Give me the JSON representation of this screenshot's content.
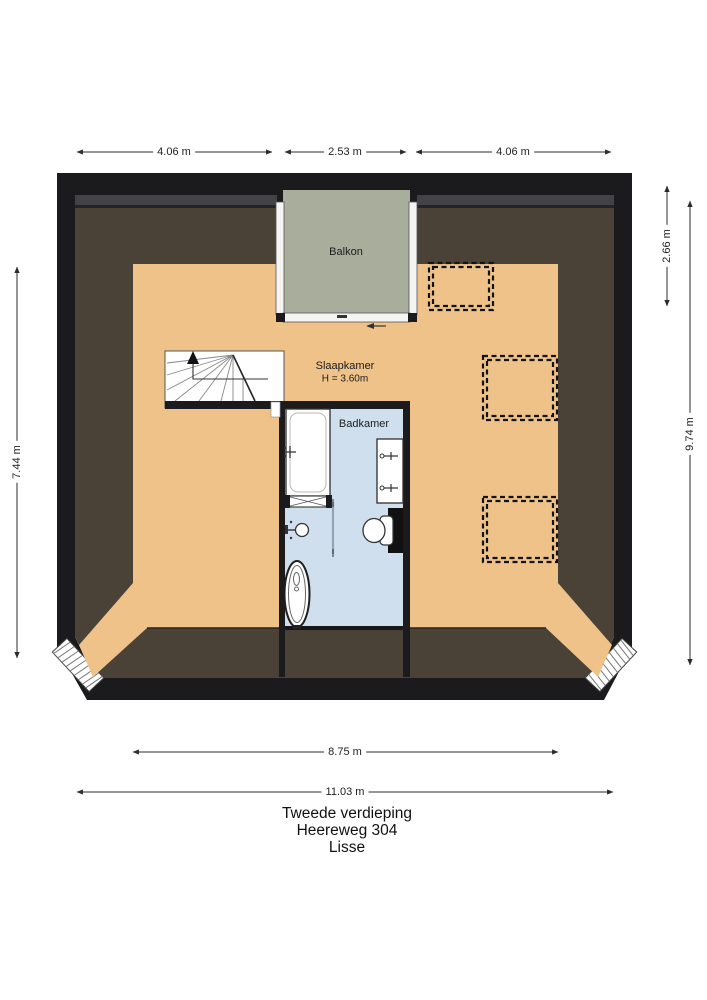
{
  "plan": {
    "rooms": {
      "balkon": {
        "label": "Balkon"
      },
      "slaapkamer": {
        "label": "Slaapkamer",
        "ceiling_height": "H = 3.60m"
      },
      "badkamer": {
        "label": "Badkamer"
      }
    },
    "dimensions": {
      "top_left": "4.06 m",
      "top_center": "2.53 m",
      "top_right": "4.06 m",
      "right_balcony_depth": "2.66 m",
      "right_total": "9.74 m",
      "left_height": "7.44 m",
      "bottom_inner": "8.75 m",
      "bottom_total": "11.03 m"
    },
    "title": {
      "floor": "Tweede verdieping",
      "address": "Heereweg 304",
      "city": "Lisse"
    },
    "colors": {
      "wall": "#1b1b1d",
      "roof_slope": "#4a4236",
      "floor": "#eec289",
      "balcony_floor": "#a9ad9c",
      "bathroom_floor": "#cfdfee"
    }
  }
}
